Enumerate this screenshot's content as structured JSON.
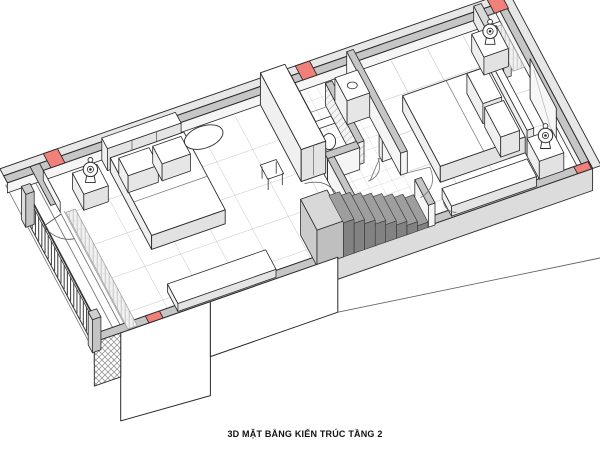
{
  "caption": {
    "text": "3D MẶT BẰNG KIẾN TRÚC TẦNG 2"
  },
  "colors": {
    "line": "#2b2b2b",
    "faint_line": "#8a8a8a",
    "wall_cut": "#c6c6c6",
    "wall_face_outer": "#e7e7e7",
    "wall_face_inner": "#f5f5f5",
    "column_marker": "#f0807a",
    "stair_step_top": "#9e9e9e",
    "stair_step_face": "#828282",
    "stair_landing": "#d8d8d8",
    "floor": "#ffffff",
    "tile_line": "#cfcfcf",
    "furniture_top": "#ffffff",
    "furniture_side": "#e9e9e9",
    "furniture_shade": "#dcdcdc",
    "slab_edge": "#666666"
  }
}
